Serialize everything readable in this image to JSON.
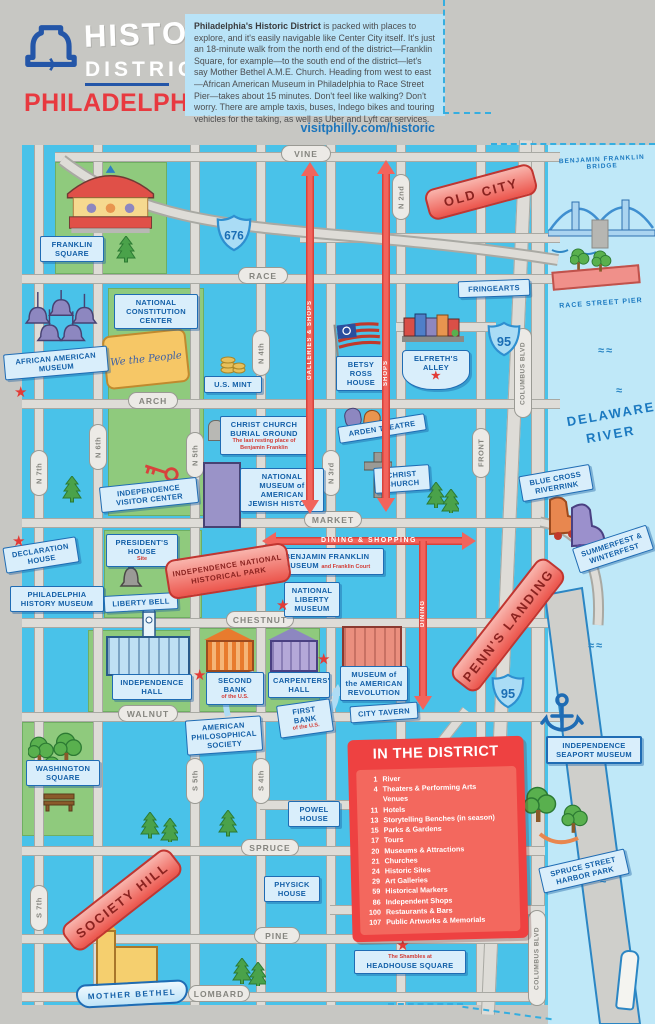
{
  "header": {
    "logo_line1": "HISTORIC",
    "logo_line2": "DISTRICT",
    "logo_line3": "PHILADELPHIA",
    "intro_bold": "Philadelphia's Historic District",
    "intro_text": " is packed with places to explore, and it's easily navigable like Center City itself. It's just an 18-minute walk from the north end of the district—Franklin Square, for example—to the south end of the district—let's say Mother Bethel A.M.E. Church. Heading from west to east—African American Museum in Philadelphia to Race Street Pier—takes about 15 minutes. Don't feel like walking? Don't worry. There are ample taxis, buses, Indego bikes and touring vehicles for the taking, as well as Uber and Lyft car services.",
    "link": "visitphilly.com/historic"
  },
  "streets": {
    "h": [
      "VINE",
      "RACE",
      "ARCH",
      "MARKET",
      "CHESTNUT",
      "WALNUT",
      "SPRUCE",
      "PINE",
      "LOMBARD"
    ],
    "v": [
      "N 7th",
      "N 6th",
      "N 5th",
      "N 4th",
      "N 3rd",
      "N 2nd",
      "FRONT",
      "COLUMBUS BLVD",
      "S 7th",
      "S 5th",
      "S 4th",
      "COLUMBUS BLVD"
    ]
  },
  "highways": [
    "676",
    "95",
    "95"
  ],
  "districts": {
    "old_city": "OLD CITY",
    "penns_landing": "PENN'S LANDING",
    "society_hill": "SOCIETY HILL",
    "inhp_line1": "INDEPENDENCE NATIONAL",
    "inhp_line2": "HISTORICAL PARK"
  },
  "arrows": {
    "galleries": "GALLERIES & SHOPS",
    "shops": "SHOPS",
    "dining_shopping": "DINING & SHOPPING",
    "dining": "DINING"
  },
  "water": {
    "river_line1": "DELAWARE",
    "river_line2": "RIVER",
    "bridge": "BENJAMIN FRANKLIN BRIDGE",
    "race_pier": "RACE STREET PIER"
  },
  "pois": {
    "franklin_square": "FRANKLIN SQUARE",
    "african_american_museum": "AFRICAN AMERICAN MUSEUM",
    "constitution_center": "NATIONAL CONSTITUTION CENTER",
    "we_the_people": "We the People",
    "us_mint": "U.S. MINT",
    "burial_ground": "CHRIST CHURCH BURIAL GROUND",
    "burial_ground_sub": "The last resting place of Benjamin Franklin",
    "betsy_ross": "BETSY ROSS HOUSE",
    "elfreths_alley": "ELFRETH'S ALLEY",
    "fringearts": "FRINGEARTS",
    "arden_theatre": "ARDEN THEATRE",
    "christ_church": "CHRIST CHURCH",
    "visitor_center": "INDEPENDENCE VISITOR CENTER",
    "jewish_history": "NATIONAL MUSEUM of AMERICAN JEWISH HISTORY",
    "presidents_house": "PRESIDENT'S HOUSE",
    "presidents_house_sub": "Site",
    "declaration_house": "DECLARATION HOUSE",
    "philadelphia_history_museum": "PHILADELPHIA HISTORY MUSEUM",
    "liberty_bell": "LIBERTY BELL",
    "bf_museum": "BENJAMIN FRANKLIN MUSEUM",
    "bf_museum_sub": "and Franklin Court",
    "national_liberty_museum": "NATIONAL LIBERTY MUSEUM",
    "independence_hall": "INDEPENDENCE HALL",
    "second_bank": "SECOND BANK",
    "second_bank_sub": "of the U.S.",
    "carpenters_hall": "CARPENTERS' HALL",
    "am_revolution": "MUSEUM of the AMERICAN REVOLUTION",
    "aps": "AMERICAN PHILOSOPHICAL SOCIETY",
    "first_bank": "FIRST BANK",
    "first_bank_sub": "of the U.S.",
    "city_tavern": "CITY TAVERN",
    "washington_square": "WASHINGTON SQUARE",
    "powel_house": "POWEL HOUSE",
    "physick_house": "PHYSICK HOUSE",
    "mother_bethel": "MOTHER BETHEL",
    "headhouse_sub": "The Shambles at",
    "headhouse": "HEADHOUSE SQUARE",
    "blue_cross": "BLUE CROSS RIVERRINK",
    "summerfest": "SUMMERFEST & WINTERFEST",
    "seaport_museum": "INDEPENDENCE SEAPORT MUSEUM",
    "harbor_park": "SPRUCE STREET HARBOR PARK"
  },
  "legend": {
    "title": "IN THE DISTRICT",
    "items": [
      {
        "n": "1",
        "label": "River"
      },
      {
        "n": "4",
        "label": "Theaters & Performing Arts Venues"
      },
      {
        "n": "11",
        "label": "Hotels"
      },
      {
        "n": "13",
        "label": "Storytelling Benches (in season)"
      },
      {
        "n": "15",
        "label": "Parks & Gardens"
      },
      {
        "n": "17",
        "label": "Tours"
      },
      {
        "n": "20",
        "label": "Museums & Attractions"
      },
      {
        "n": "21",
        "label": "Churches"
      },
      {
        "n": "24",
        "label": "Historic Sites"
      },
      {
        "n": "29",
        "label": "Art Galleries"
      },
      {
        "n": "59",
        "label": "Historical Markers"
      },
      {
        "n": "86",
        "label": "Independent Shops"
      },
      {
        "n": "100",
        "label": "Restaurants & Bars"
      },
      {
        "n": "107",
        "label": "Public Artworks & Memorials"
      }
    ]
  }
}
